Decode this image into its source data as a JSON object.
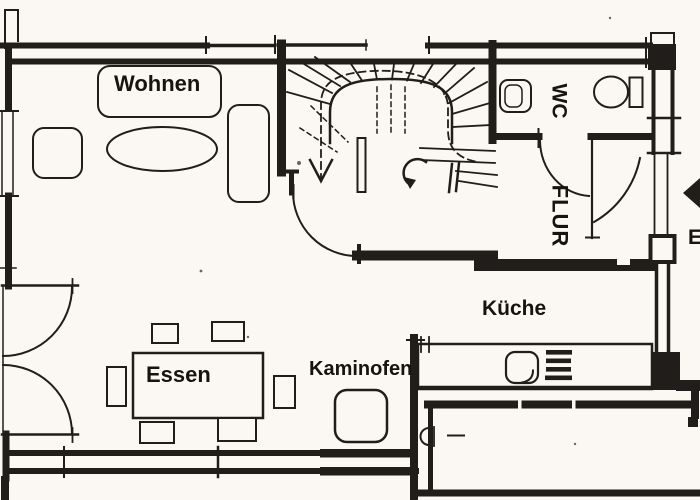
{
  "plan": {
    "title_hint": "apartment ground floor plan",
    "labels": {
      "wohnen": "Wohnen",
      "essen": "Essen",
      "kueche": "Küche",
      "kaminofen": "Kaminofen",
      "wc": "WC",
      "flur": "FLUR",
      "entrance": "E"
    },
    "colors": {
      "ink": "#201d1a",
      "paper": "#fbf7f3"
    }
  }
}
